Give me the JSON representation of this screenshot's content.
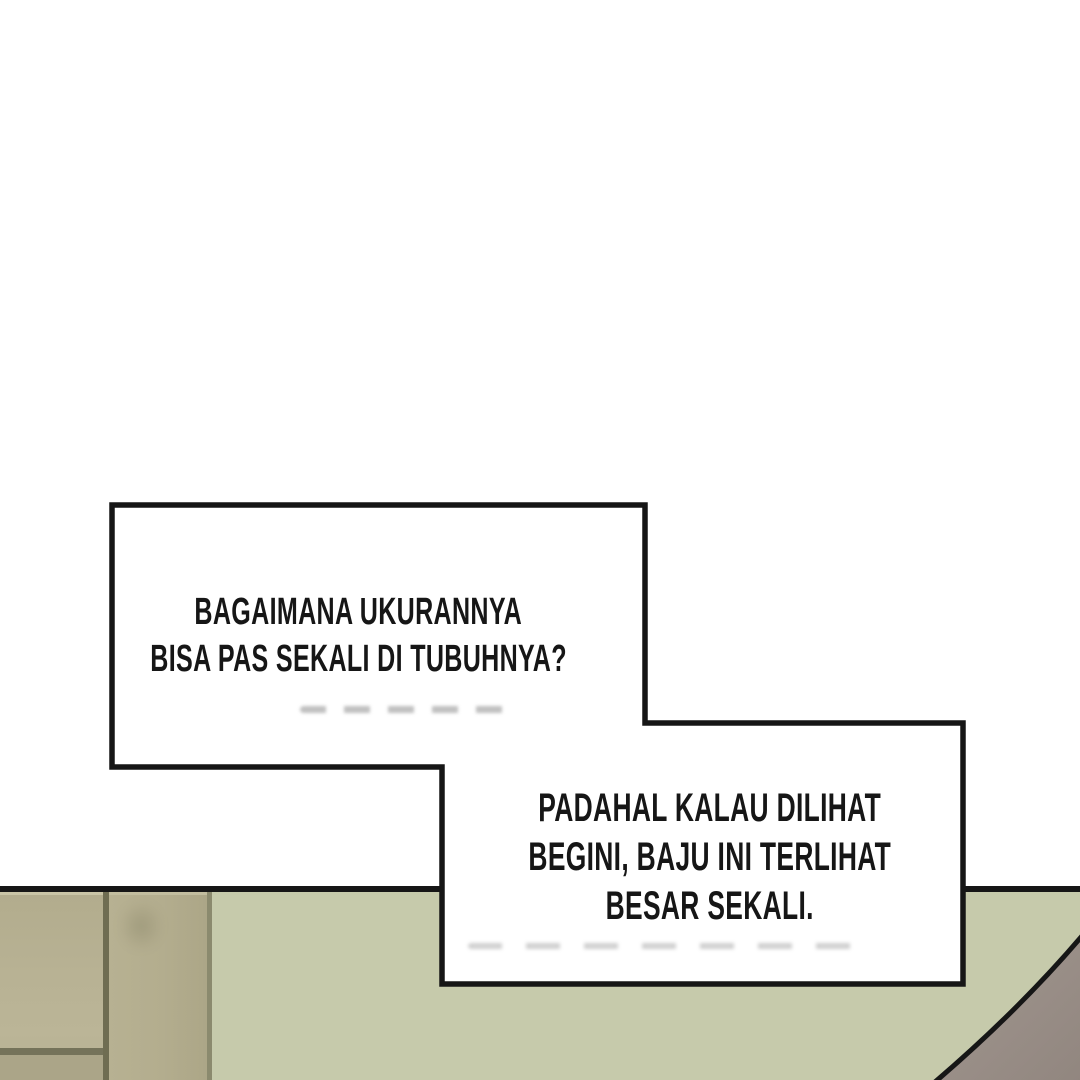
{
  "speech_bubble_1": {
    "lines": [
      "BAGAIMANA UKURANNYA",
      "BISA PAS SEKALI DI TUBUHNYA?"
    ]
  },
  "speech_bubble_2": {
    "lines": [
      "PADAHAL KALAU DILIHAT",
      "BEGINI, BAJU INI TERLIHAT",
      "BESAR SEKALI."
    ]
  },
  "colors": {
    "ink": "#161616",
    "paper": "#ffffff",
    "wall": "#c6caab",
    "cabinet": "#b6b092",
    "cabinetShadow": "#aba588",
    "cabinetRail": "#75735a",
    "seamDark": "#6f6d52",
    "seamLight": "#8b8a6e",
    "figureLight": "#a29790",
    "figureDark": "#91867f"
  }
}
